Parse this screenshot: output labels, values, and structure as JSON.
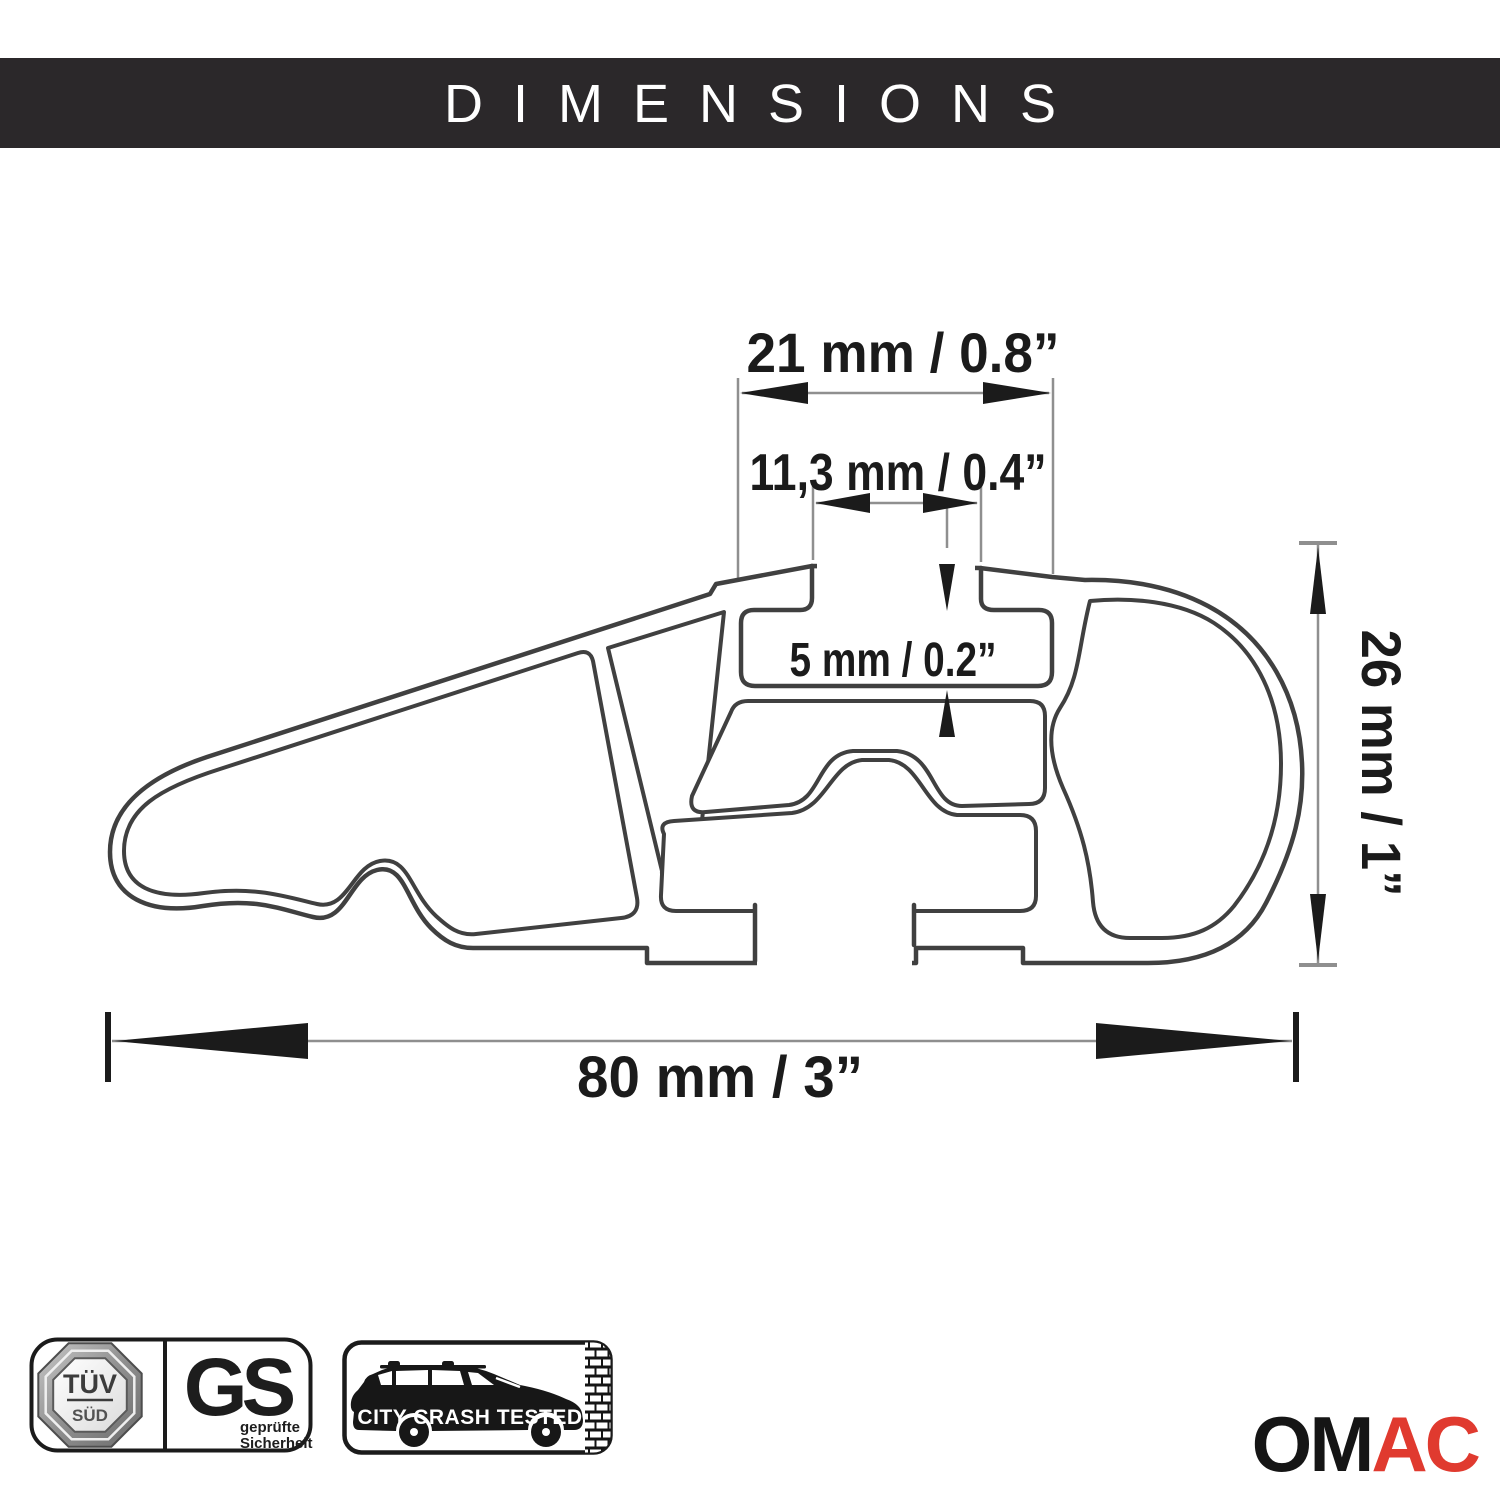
{
  "header": {
    "title": "DIMENSIONS"
  },
  "diagram": {
    "dim_channel_width": "21 mm / 0.8”",
    "dim_slot_opening": "11,3 mm / 0.4”",
    "dim_slot_depth": "5 mm / 0.2”",
    "dim_profile_height": "26 mm / 1”",
    "dim_profile_width": "80 mm / 3”",
    "line_color": "#404040",
    "dim_gray": "#8f8f8f",
    "dim_black": "#1b1b1b"
  },
  "certifications": {
    "tuv": {
      "line1": "TÜV",
      "line2": "SÜD"
    },
    "gs": {
      "label": "GS",
      "sub1": "geprüfte",
      "sub2": "Sicherheit"
    },
    "crash": {
      "label": "CITY CRASH TESTED"
    }
  },
  "brand": {
    "om": "OM",
    "ac": "AC",
    "red": "#e03a2f",
    "black": "#151515"
  }
}
